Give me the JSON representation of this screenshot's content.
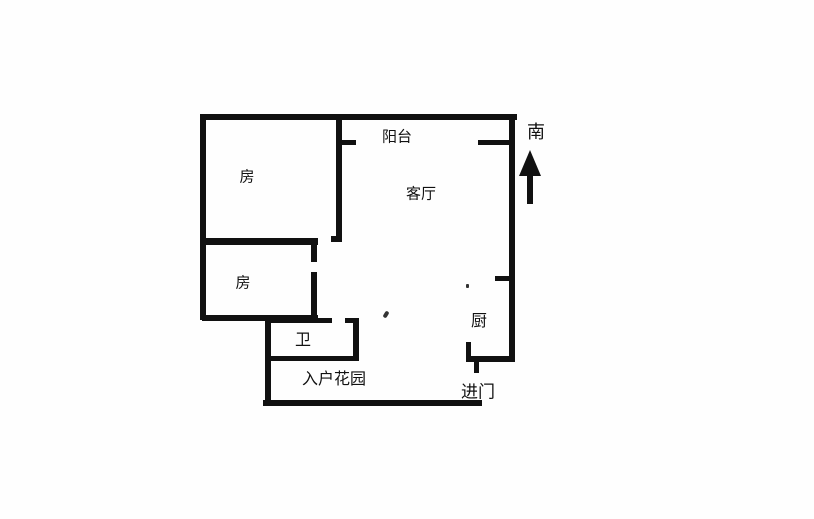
{
  "floor_plan": {
    "labels": {
      "room1": "房",
      "room2": "房",
      "balcony": "阳台",
      "living_room": "客厅",
      "bathroom": "卫",
      "entrance_garden": "入户花园",
      "kitchen": "厨",
      "entry_door": "进门",
      "south": "南"
    },
    "colors": {
      "wall": "#111111",
      "background": "#fefefe",
      "text": "#111111"
    }
  }
}
